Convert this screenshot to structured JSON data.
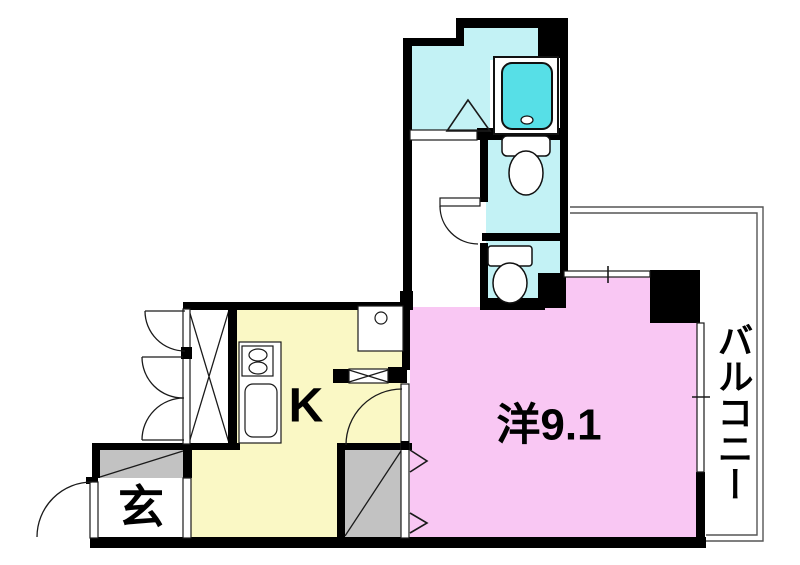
{
  "plan": {
    "title": "apartment-floor-plan",
    "rooms": {
      "main_room": {
        "label": "洋9.1"
      },
      "kitchen": {
        "label": "K"
      },
      "entrance": {
        "label": "玄"
      },
      "balcony": {
        "label": "バルコニー"
      }
    },
    "colors": {
      "wall": "#000000",
      "main_room": "#f9c7f3",
      "kitchen": "#faf8c5",
      "wet_area": "#c3f2f5",
      "bathtub": "#57dfe7",
      "gray_area": "#c2c2c2",
      "white": "#ffffff"
    }
  }
}
